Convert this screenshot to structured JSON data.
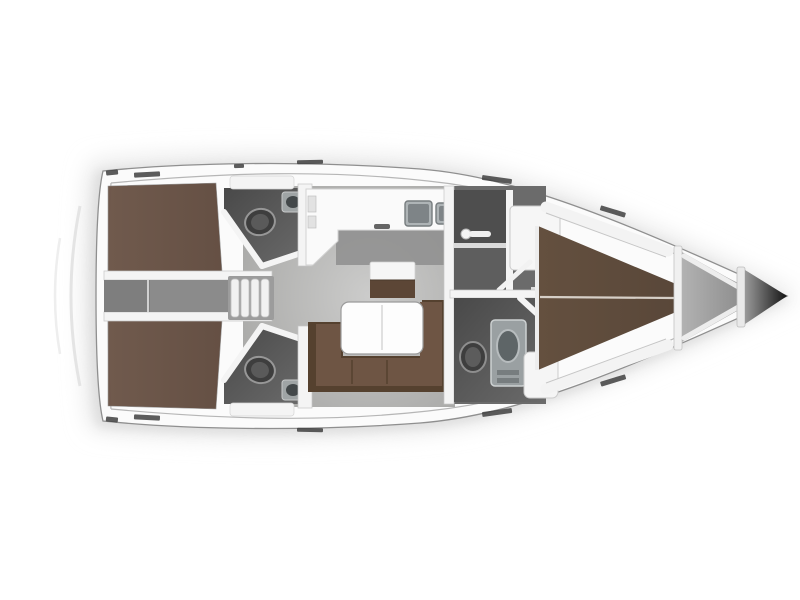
{
  "diagram": {
    "type": "floor-plan",
    "subject": "sailing-yacht interior layout, top-down view, bow pointing right",
    "orientation": {
      "bow": "right",
      "stern": "left"
    }
  },
  "rooms": [
    {
      "id": "aft-cabin-port",
      "name": "aft double cabin (top)"
    },
    {
      "id": "aft-cabin-starboard",
      "name": "aft double cabin (bottom)"
    },
    {
      "id": "companionway",
      "name": "companionway steps between aft cabins"
    },
    {
      "id": "head-aft-port",
      "name": "aft head with toilet and corner sink (top)"
    },
    {
      "id": "head-aft-starboard",
      "name": "aft head with toilet and corner sink (bottom)"
    },
    {
      "id": "galley",
      "name": "L-shaped galley with double sink"
    },
    {
      "id": "salon",
      "name": "salon with U-shaped sofa, folding table and bench seat"
    },
    {
      "id": "shower-room",
      "name": "separate shower compartment"
    },
    {
      "id": "head-forward",
      "name": "forward head with toilet and washbasin unit"
    },
    {
      "id": "forward-cabin",
      "name": "forward V-berth double cabin with side shelves"
    },
    {
      "id": "anchor-locker",
      "name": "bow anchor locker"
    }
  ],
  "fixtures": [
    "toilet",
    "corner-sink",
    "double-sink",
    "folding-table",
    "u-shaped-sofa",
    "companionway-steps",
    "shower-head",
    "door-swing",
    "wardrobe",
    "washbasin-unit",
    "v-berth-bed",
    "aft-double-bed",
    "bow-bulkhead"
  ],
  "colors": {
    "background": "#ffffff",
    "hull_white": "#fbfbfb",
    "hull_outline": "#8f8f8f",
    "deck_line": "#b6b6b6",
    "shadow": "#d6d6d6",
    "floor_light": "#cccccb",
    "floor_mid": "#a0a09e",
    "corridor_gray": "#7e7e7e",
    "room_dark": "#565656",
    "wall_white": "#f4f4f4",
    "wall_edge": "#c6c6c6",
    "bed_brown_aft": "#6e574a",
    "bed_brown_fwd": "#64503f",
    "bed_seam": "#d6cfc7",
    "sofa_dark": "#55412f",
    "sofa_seat": "#6e5544",
    "seat_front_brown": "#5c4636",
    "table_white": "#fdfdfd",
    "table_edge": "#9b9b9b",
    "counter_white": "#fafafa",
    "fixture_gray": "#aeb4b6",
    "fixture_dark": "#3e3e3e",
    "basin_gray": "#7e8487",
    "locker_gray": "#a3a3a3",
    "bow_tip_dark": "#131313",
    "deck_mark": "#3f3f3f",
    "steps_white": "#f1f1f1"
  }
}
